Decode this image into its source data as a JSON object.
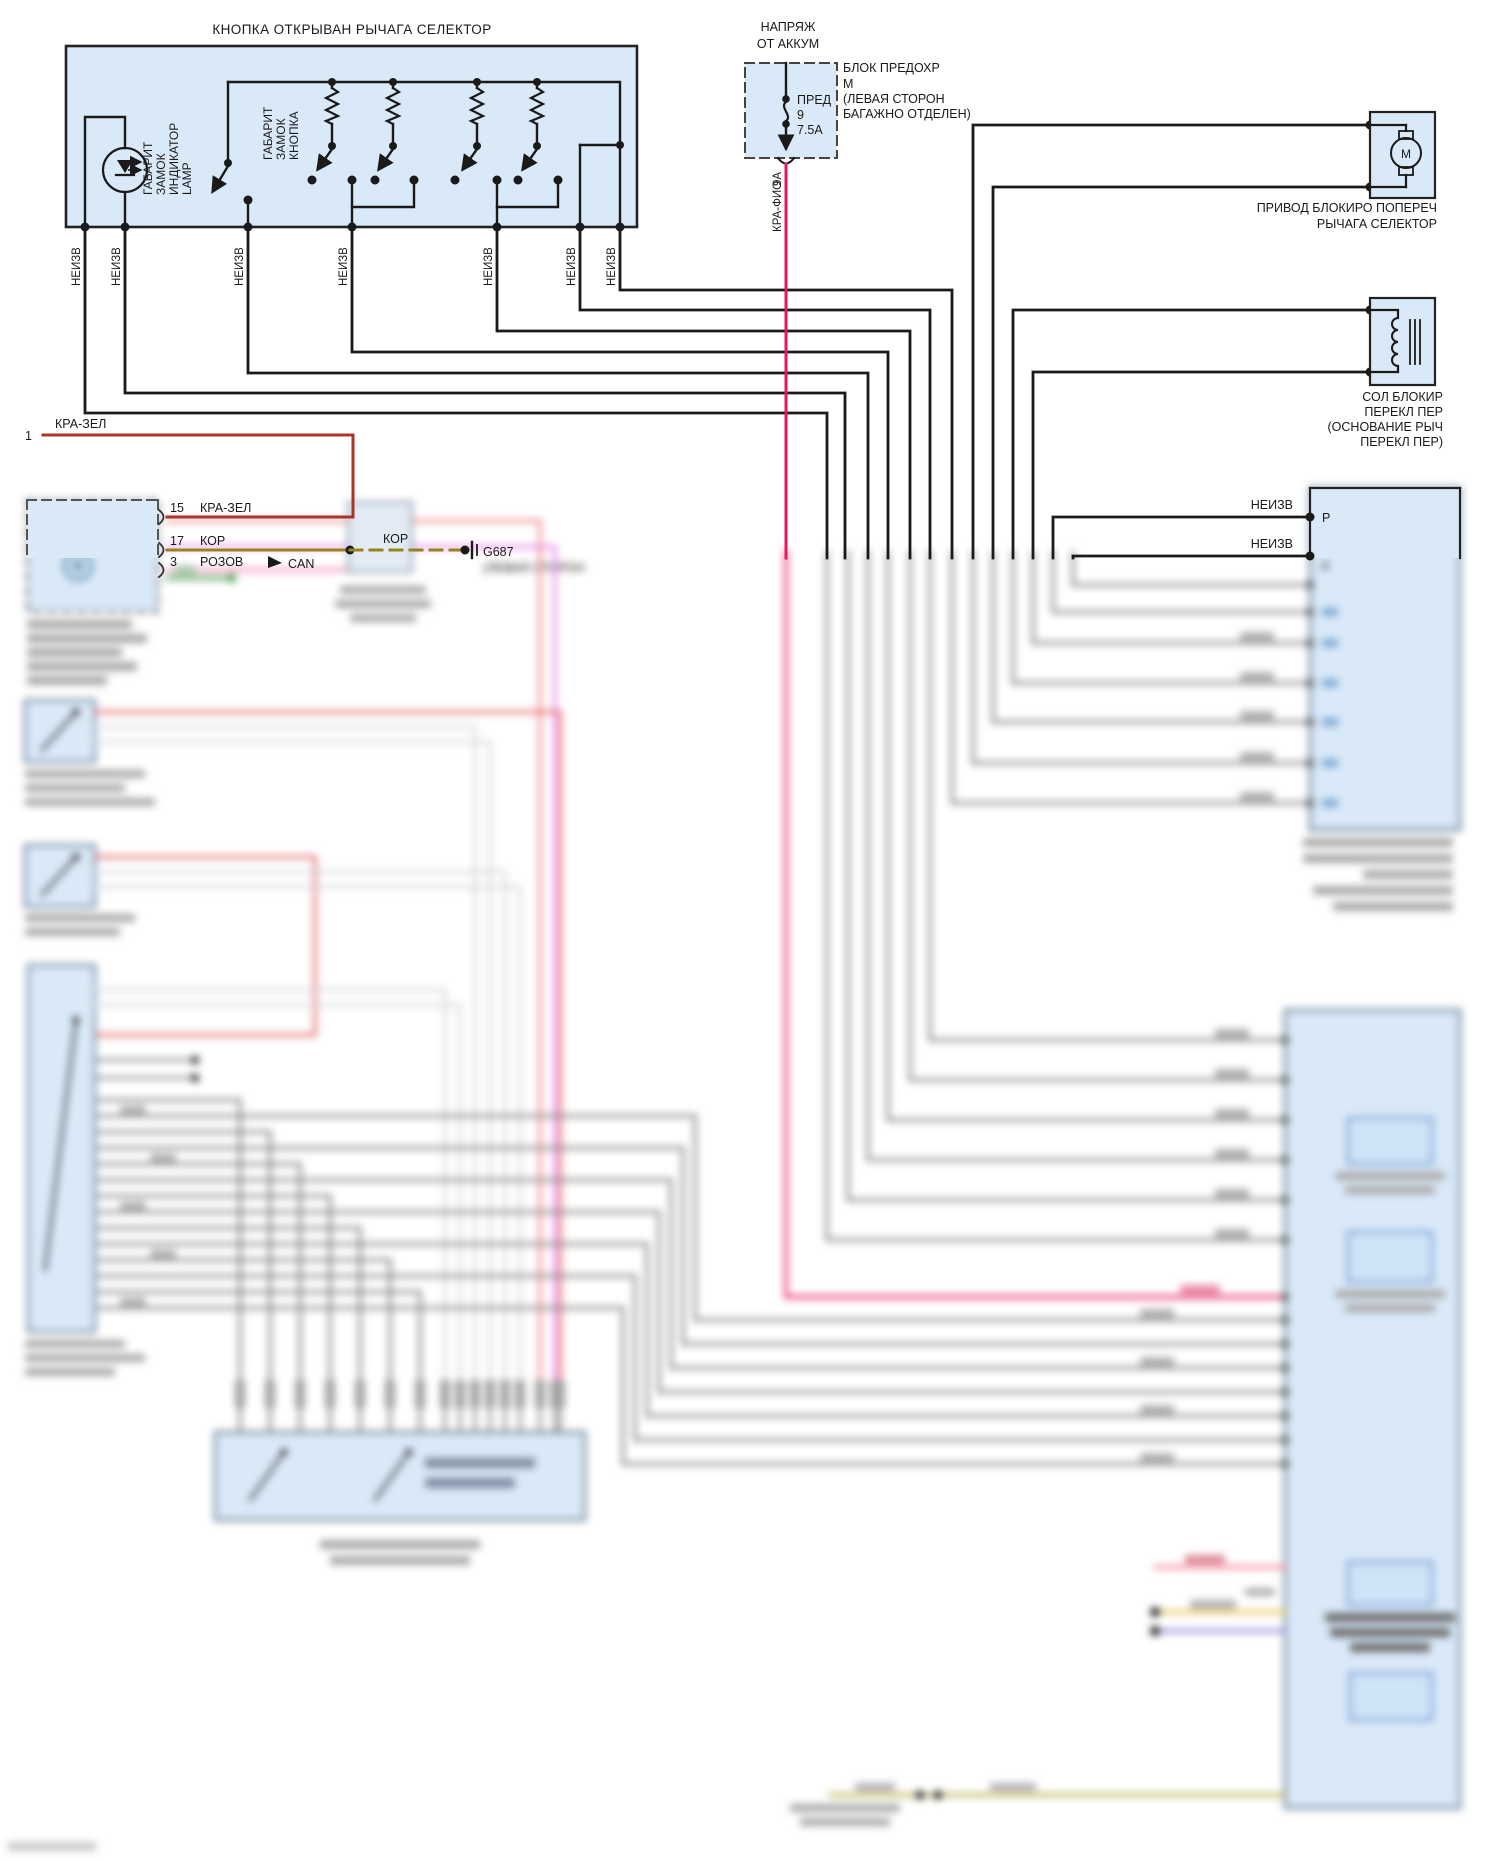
{
  "labels": {
    "unknown": "НЕИЗВ",
    "top_box_title": "КНОПКА ОТКРЫВАН РЫЧАГА СЕЛЕКТОР",
    "indicator_lamp": [
      "ГАБАРИТ",
      "ЗАМОК",
      "ИНДИКАТОР",
      "LAMP"
    ],
    "lock_button": [
      "ГАБАРИТ",
      "ЗАМОК",
      "КНОПКА"
    ]
  },
  "fuse": {
    "source_line1": "НАПРЯЖ",
    "source_line2": "ОТ АККУМ",
    "name": "ПРЕД",
    "number": "9",
    "rating": "7.5А",
    "block_label": [
      "БЛОК ПРЕДОХР",
      "М",
      "(ЛЕВАЯ СТОРОН",
      "БАГАЖНО ОТДЕЛЕН)"
    ],
    "wire_color": "КРА-ФИО",
    "wire_gauge": "9А"
  },
  "motor": {
    "symbol": "M",
    "label_line1": "ПРИВОД БЛОКИРО ПОПЕРЕЧ",
    "label_line2": "РЫЧАГА СЕЛЕКТОР"
  },
  "solenoid": {
    "label": [
      "СОЛ БЛОКИР",
      "ПЕРЕКЛ ПЕР",
      "(ОСНОВАНИЕ РЫЧ",
      "ПЕРЕКЛ ПЕР)"
    ]
  },
  "left_connector": {
    "wire1_number": "1",
    "wire1_color": "КРА-ЗЕЛ",
    "pin15_num": "15",
    "pin15_color": "КРА-ЗЕЛ",
    "pin17_num": "17",
    "pin17_color": "КОР",
    "pin3_num": "3",
    "pin3_color": "РОЗОВ",
    "mid_wire_label": "КОР",
    "can_label": "CAN"
  },
  "ground": {
    "id": "G687",
    "location": "(ЛЕВАЯ СТОРОН"
  },
  "right_module": {
    "pin_p": "P",
    "pin_a": "A"
  },
  "colors": {
    "box_fill": "#d9e9f8",
    "box_stroke": "#222222",
    "wire_black": "#1a1a1a",
    "wire_red_green": "#ab3428",
    "wire_red_violet": "#e8175d",
    "wire_brown": "#95851a",
    "wire_pink": "#f07eb0",
    "wire_green": "#2e8b2e",
    "wire_gray": "#8a8a8a",
    "wire_salmon": "#f08080",
    "wire_magenta": "#e87ae8",
    "wire_yellow": "#e5c24c",
    "wire_purple": "#8f7fd4",
    "wire_tan": "#b5a642"
  }
}
